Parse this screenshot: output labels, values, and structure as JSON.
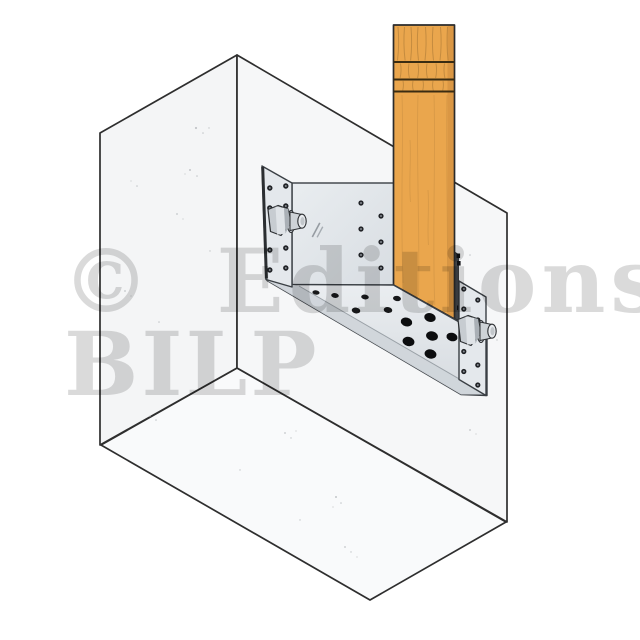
{
  "watermark": {
    "line1": "© Editions",
    "line2": "BILP"
  },
  "colors": {
    "background": "#ffffff",
    "block_face_left": "#f4f5f6",
    "block_face_right": "#f6f7f8",
    "block_face_bottom": "#f9fafb",
    "block_edge": "#2e2e2e",
    "wood": "#eaa64d",
    "wood_grain": "#b5803a",
    "wood_edge": "#2b2b2b",
    "steel_plate": "#e4e8ec",
    "steel_lip": "#d0d5da",
    "steel_edge": "#3a3f44",
    "plate_edge_dark": "#42464a",
    "hole_small": "#1f2124",
    "hole_large": "#0c0d0f",
    "watermark_gray": "rgba(0,0,0,0.145)"
  },
  "parts": {
    "block": "concrete-block",
    "post": "timber-post",
    "bracket": "galvanized-corner-bracket",
    "left_bolt": "hex-bolt-left",
    "right_bolt": "hex-bolt-right"
  }
}
